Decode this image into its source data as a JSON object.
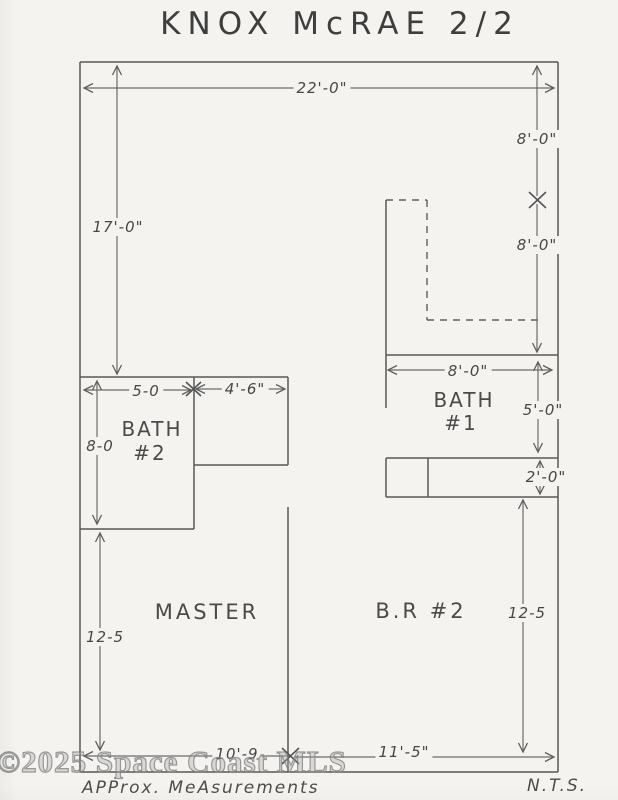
{
  "title": "KNOX McRAE 2/2",
  "watermark": "©2025 Space Coast MLS",
  "footer": {
    "approx_note": "APProx. MeAsurements",
    "nts": "N.T.S."
  },
  "rooms": {
    "master": "MASTER",
    "br2": "B.R #2",
    "bath1_line1": "BATH",
    "bath1_line2": "#1",
    "bath2_line1": "BATH",
    "bath2_line2": "#2"
  },
  "dimensions": {
    "top_width": "22'-0\"",
    "left_height": "17'-0\"",
    "right_upper": "8'-0\"",
    "right_lower": "8'-0\"",
    "bath1_width": "8'-0\"",
    "bath1_height": "5'-0\"",
    "vanity_depth": "2'-0\"",
    "br2_height": "12-5",
    "bath2_width": "5-0",
    "closet_width": "4'-6\"",
    "bath2_height": "8-0",
    "master_height": "12-5",
    "master_width": "10'-9",
    "br2_width": "11'-5\""
  },
  "colors": {
    "paper": "#f4f3f0",
    "pencil_wall": "#585858",
    "pencil_dim": "#6b6b6b",
    "ink_text": "#474747"
  }
}
